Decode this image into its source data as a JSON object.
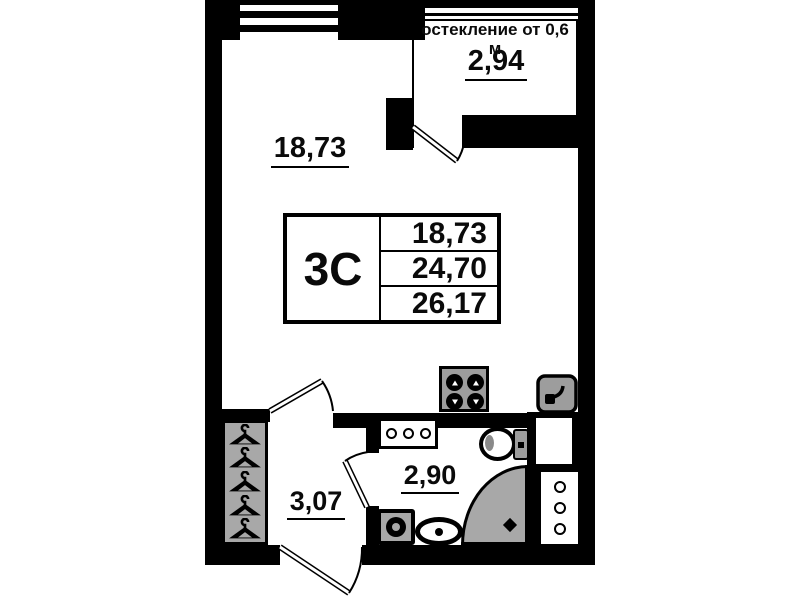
{
  "floor_plan": {
    "glazing_note": "остекление от 0,6 м",
    "unit_label": "3С",
    "unit_table": {
      "rows": [
        "18,73",
        "24,70",
        "26,17"
      ]
    },
    "areas": {
      "living_room": "18,73",
      "balcony": "2,94",
      "hallway": "3,07",
      "bathroom": "2,90"
    },
    "colors": {
      "wall": "#000000",
      "fixture_fill": "#a8a8a8",
      "background": "#ffffff"
    },
    "icons": {
      "hanger-icon": "svg-triangle-with-hook",
      "stove-burner-icon": "black-circle-white-arrow",
      "kitchen-sink-icon": "rounded-square-with-faucet",
      "toilet-icon": "oval-bowl-with-tank",
      "washing-machine-icon": "square-with-drum-circle",
      "washbasin-icon": "oval-with-drain-dot",
      "corner-shower-icon": "quarter-circle-tray-with-drain",
      "vanity-holes-icon": "three-outline-circles",
      "shaft-vent-icon": "three-outline-circles-vertical",
      "door-icon": "double-line-leaf-with-swing-arc",
      "window-icon": "parallel-glazing-lines"
    }
  }
}
